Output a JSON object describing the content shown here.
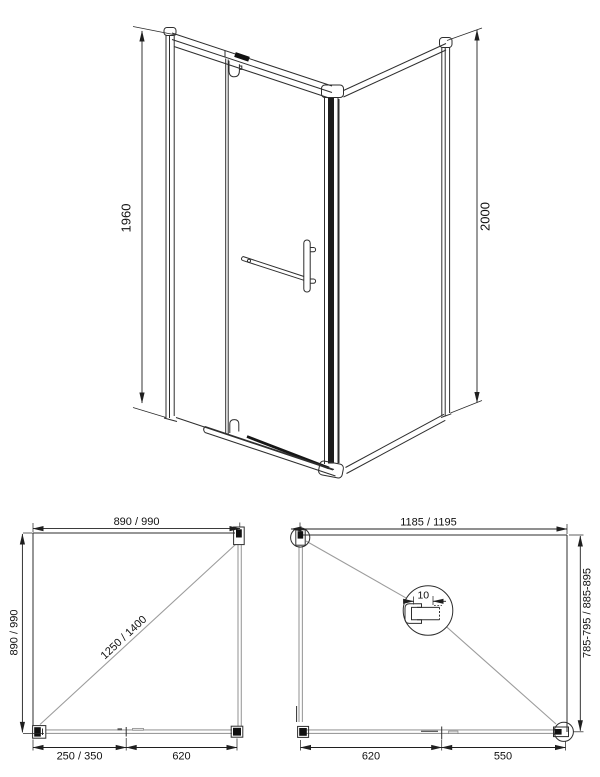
{
  "colors": {
    "background": "#ffffff",
    "line": "#2e2e2e",
    "glass_wall": "#9c9c9c",
    "dimension": "#1f1f1f"
  },
  "view_3d": {
    "height_left": "1960",
    "height_right": "2000"
  },
  "plan_square": {
    "width": "890 / 990",
    "depth": "890 / 990",
    "diagonal": "1250 / 1400",
    "fixed_panel": "250 / 350",
    "door": "620"
  },
  "plan_rect": {
    "width": "1185 / 1195",
    "depth": "785-795 / 885-895",
    "door": "620",
    "fixed_panel": "550",
    "glass_thickness": "10"
  }
}
